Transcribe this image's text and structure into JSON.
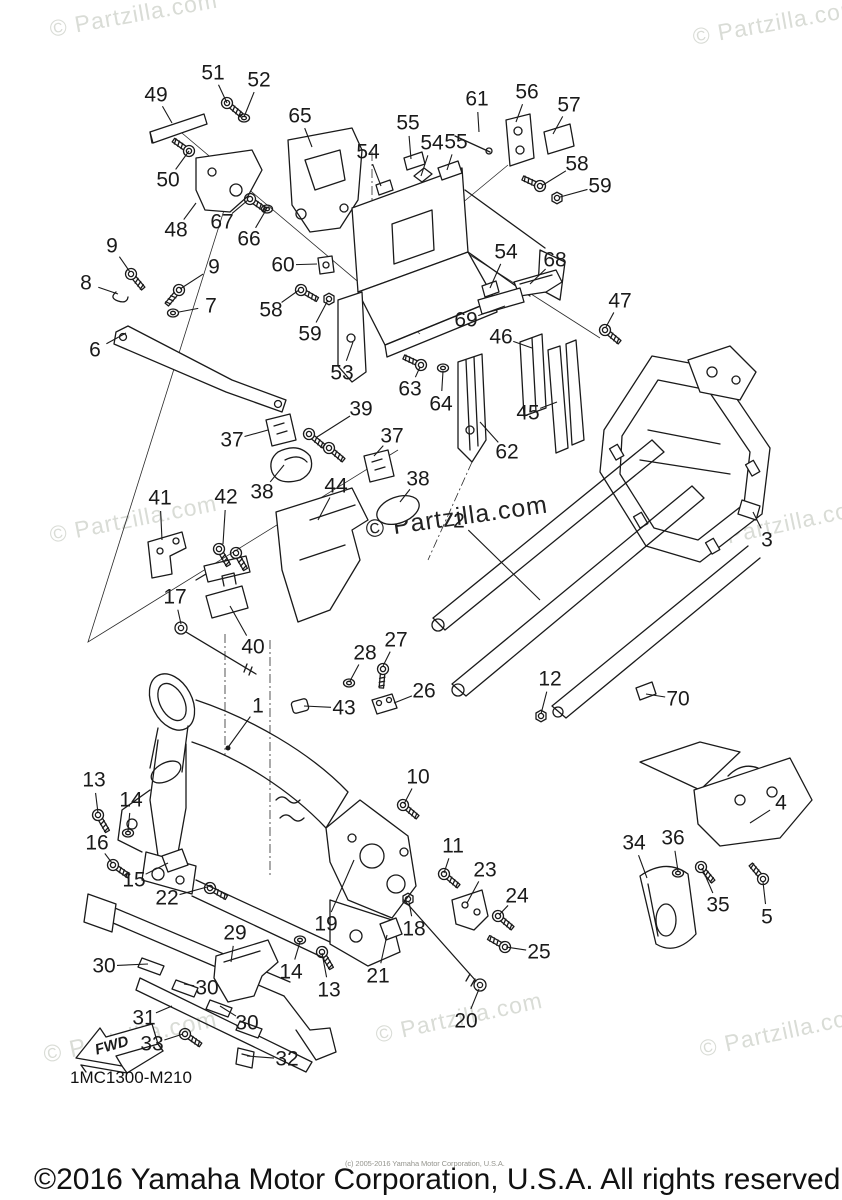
{
  "page": {
    "background": "#ffffff",
    "line_color": "#1a1a1a",
    "watermark_light_color": "#d9dcd6",
    "watermark_dark_color": "#222222",
    "fine_print_color": "#95958e"
  },
  "diagram": {
    "code": "1MC1300-M210",
    "fwd_label": "FWD",
    "callouts": [
      {
        "n": "51",
        "x": 213,
        "y": 73,
        "ex": 227,
        "ey": 103
      },
      {
        "n": "52",
        "x": 259,
        "y": 80,
        "ex": 244,
        "ey": 117
      },
      {
        "n": "49",
        "x": 156,
        "y": 95,
        "ex": 172,
        "ey": 123
      },
      {
        "n": "65",
        "x": 300,
        "y": 116,
        "ex": 312,
        "ey": 147
      },
      {
        "n": "50",
        "x": 168,
        "y": 180,
        "ex": 189,
        "ey": 151
      },
      {
        "n": "48",
        "x": 176,
        "y": 230,
        "ex": 196,
        "ey": 203
      },
      {
        "n": "67",
        "x": 222,
        "y": 222,
        "ex": 248,
        "ey": 200
      },
      {
        "n": "66",
        "x": 249,
        "y": 239,
        "ex": 266,
        "ey": 210
      },
      {
        "n": "60",
        "x": 283,
        "y": 265,
        "ex": 317,
        "ey": 264
      },
      {
        "n": "9",
        "x": 112,
        "y": 246,
        "ex": 130,
        "ey": 272
      },
      {
        "n": "9",
        "x": 214,
        "y": 267,
        "ex": 180,
        "ey": 289
      },
      {
        "n": "8",
        "x": 86,
        "y": 283,
        "ex": 118,
        "ey": 294
      },
      {
        "n": "7",
        "x": 211,
        "y": 306,
        "ex": 179,
        "ey": 312
      },
      {
        "n": "6",
        "x": 95,
        "y": 350,
        "ex": 126,
        "ey": 333
      },
      {
        "n": "58",
        "x": 271,
        "y": 310,
        "ex": 299,
        "ey": 290
      },
      {
        "n": "59",
        "x": 310,
        "y": 334,
        "ex": 328,
        "ey": 300
      },
      {
        "n": "53",
        "x": 342,
        "y": 373,
        "ex": 353,
        "ey": 342
      },
      {
        "n": "63",
        "x": 410,
        "y": 389,
        "ex": 420,
        "ey": 367
      },
      {
        "n": "64",
        "x": 441,
        "y": 404,
        "ex": 443,
        "ey": 371
      },
      {
        "n": "39",
        "x": 361,
        "y": 409,
        "ex": 317,
        "ey": 437
      },
      {
        "n": "37",
        "x": 232,
        "y": 440,
        "ex": 268,
        "ey": 430
      },
      {
        "n": "37",
        "x": 392,
        "y": 436,
        "ex": 374,
        "ey": 456
      },
      {
        "n": "38",
        "x": 262,
        "y": 492,
        "ex": 284,
        "ey": 465
      },
      {
        "n": "38",
        "x": 418,
        "y": 479,
        "ex": 400,
        "ey": 502
      },
      {
        "n": "44",
        "x": 336,
        "y": 486,
        "ex": 318,
        "ey": 520
      },
      {
        "n": "41",
        "x": 160,
        "y": 498,
        "ex": 162,
        "ey": 540
      },
      {
        "n": "42",
        "x": 226,
        "y": 497,
        "ex": 223,
        "ey": 544
      },
      {
        "n": "17",
        "x": 175,
        "y": 597,
        "ex": 181,
        "ey": 624
      },
      {
        "n": "40",
        "x": 253,
        "y": 647,
        "ex": 230,
        "ey": 606
      },
      {
        "n": "54",
        "x": 368,
        "y": 152,
        "ex": 381,
        "ey": 186
      },
      {
        "n": "55",
        "x": 408,
        "y": 123,
        "ex": 411,
        "ey": 159
      },
      {
        "n": "54",
        "x": 432,
        "y": 143,
        "ex": 421,
        "ey": 176
      },
      {
        "n": "55",
        "x": 456,
        "y": 142,
        "ex": 447,
        "ey": 170
      },
      {
        "n": "61",
        "x": 477,
        "y": 99,
        "ex": 479,
        "ey": 132
      },
      {
        "n": "56",
        "x": 527,
        "y": 92,
        "ex": 516,
        "ey": 122
      },
      {
        "n": "57",
        "x": 569,
        "y": 105,
        "ex": 553,
        "ey": 134
      },
      {
        "n": "58",
        "x": 577,
        "y": 164,
        "ex": 543,
        "ey": 185
      },
      {
        "n": "59",
        "x": 600,
        "y": 186,
        "ex": 560,
        "ey": 197
      },
      {
        "n": "54",
        "x": 506,
        "y": 252,
        "ex": 490,
        "ey": 288
      },
      {
        "n": "68",
        "x": 555,
        "y": 260,
        "ex": 530,
        "ey": 284
      },
      {
        "n": "69",
        "x": 466,
        "y": 320,
        "ex": 505,
        "ey": 306
      },
      {
        "n": "46",
        "x": 501,
        "y": 337,
        "ex": 532,
        "ey": 348
      },
      {
        "n": "45",
        "x": 528,
        "y": 413,
        "ex": 557,
        "ey": 402
      },
      {
        "n": "47",
        "x": 620,
        "y": 301,
        "ex": 606,
        "ey": 327
      },
      {
        "n": "62",
        "x": 507,
        "y": 452,
        "ex": 480,
        "ey": 422
      },
      {
        "n": "2",
        "x": 459,
        "y": 521,
        "ex": 540,
        "ey": 600
      },
      {
        "n": "3",
        "x": 767,
        "y": 540,
        "ex": 753,
        "ey": 512
      },
      {
        "n": "26",
        "x": 424,
        "y": 691,
        "ex": 394,
        "ey": 703
      },
      {
        "n": "27",
        "x": 396,
        "y": 640,
        "ex": 383,
        "ey": 666
      },
      {
        "n": "28",
        "x": 365,
        "y": 653,
        "ex": 350,
        "ey": 681
      },
      {
        "n": "43",
        "x": 344,
        "y": 708,
        "ex": 304,
        "ey": 706
      },
      {
        "n": "1",
        "x": 258,
        "y": 706,
        "ex": 229,
        "ey": 746
      },
      {
        "n": "12",
        "x": 550,
        "y": 679,
        "ex": 541,
        "ey": 714
      },
      {
        "n": "70",
        "x": 678,
        "y": 699,
        "ex": 646,
        "ey": 694
      },
      {
        "n": "13",
        "x": 94,
        "y": 780,
        "ex": 98,
        "ey": 813
      },
      {
        "n": "14",
        "x": 131,
        "y": 800,
        "ex": 128,
        "ey": 831
      },
      {
        "n": "16",
        "x": 97,
        "y": 843,
        "ex": 112,
        "ey": 863
      },
      {
        "n": "15",
        "x": 134,
        "y": 880,
        "ex": 168,
        "ey": 863
      },
      {
        "n": "22",
        "x": 167,
        "y": 898,
        "ex": 207,
        "ey": 887
      },
      {
        "n": "29",
        "x": 235,
        "y": 933,
        "ex": 231,
        "ey": 962
      },
      {
        "n": "19",
        "x": 326,
        "y": 924,
        "ex": 354,
        "ey": 860
      },
      {
        "n": "14",
        "x": 291,
        "y": 972,
        "ex": 300,
        "ey": 942
      },
      {
        "n": "13",
        "x": 329,
        "y": 990,
        "ex": 322,
        "ey": 953
      },
      {
        "n": "21",
        "x": 378,
        "y": 976,
        "ex": 387,
        "ey": 935
      },
      {
        "n": "18",
        "x": 414,
        "y": 929,
        "ex": 409,
        "ey": 902
      },
      {
        "n": "10",
        "x": 418,
        "y": 777,
        "ex": 404,
        "ey": 804
      },
      {
        "n": "30",
        "x": 104,
        "y": 966,
        "ex": 148,
        "ey": 964
      },
      {
        "n": "30",
        "x": 207,
        "y": 988,
        "ex": 184,
        "ey": 984
      },
      {
        "n": "30",
        "x": 247,
        "y": 1023,
        "ex": 220,
        "ey": 1006
      },
      {
        "n": "31",
        "x": 144,
        "y": 1018,
        "ex": 172,
        "ey": 1006
      },
      {
        "n": "33",
        "x": 152,
        "y": 1044,
        "ex": 183,
        "ey": 1034
      },
      {
        "n": "32",
        "x": 287,
        "y": 1059,
        "ex": 247,
        "ey": 1056
      },
      {
        "n": "20",
        "x": 466,
        "y": 1021,
        "ex": 479,
        "ey": 989
      },
      {
        "n": "11",
        "x": 453,
        "y": 846,
        "ex": 444,
        "ey": 873
      },
      {
        "n": "23",
        "x": 485,
        "y": 870,
        "ex": 467,
        "ey": 903
      },
      {
        "n": "24",
        "x": 517,
        "y": 896,
        "ex": 499,
        "ey": 915
      },
      {
        "n": "25",
        "x": 539,
        "y": 952,
        "ex": 506,
        "ey": 947
      },
      {
        "n": "34",
        "x": 634,
        "y": 843,
        "ex": 647,
        "ey": 878
      },
      {
        "n": "36",
        "x": 673,
        "y": 838,
        "ex": 678,
        "ey": 871
      },
      {
        "n": "35",
        "x": 718,
        "y": 905,
        "ex": 702,
        "ey": 868
      },
      {
        "n": "4",
        "x": 781,
        "y": 803,
        "ex": 750,
        "ey": 823
      },
      {
        "n": "5",
        "x": 767,
        "y": 917,
        "ex": 763,
        "ey": 882
      }
    ]
  },
  "watermarks": [
    {
      "text": "© Partzilla.com",
      "x": 50,
      "y": 16,
      "rot": -10,
      "size": 23,
      "tone": "light"
    },
    {
      "text": "© Partzilla.com",
      "x": 693,
      "y": 24,
      "rot": -10,
      "size": 23,
      "tone": "light"
    },
    {
      "text": "© Partzilla.com",
      "x": 50,
      "y": 522,
      "rot": -11,
      "size": 23,
      "tone": "light"
    },
    {
      "text": "© Partzilla.com",
      "x": 366,
      "y": 516,
      "rot": -8,
      "size": 25,
      "tone": "dark"
    },
    {
      "text": "© Partzilla.com",
      "x": 702,
      "y": 528,
      "rot": -12,
      "size": 23,
      "tone": "light"
    },
    {
      "text": "© Partzilla.com",
      "x": 44,
      "y": 1042,
      "rot": -12,
      "size": 24,
      "tone": "light"
    },
    {
      "text": "© Partzilla.com",
      "x": 376,
      "y": 1022,
      "rot": -12,
      "size": 23,
      "tone": "light"
    },
    {
      "text": "© Partzilla.com",
      "x": 700,
      "y": 1036,
      "rot": -12,
      "size": 23,
      "tone": "light"
    }
  ],
  "footer": {
    "copyright": "©2016 Yamaha Motor Corporation, U.S.A. All rights reserved.",
    "small_print": "(c) 2005-2016 Yamaha Motor Corporation, U.S.A."
  }
}
